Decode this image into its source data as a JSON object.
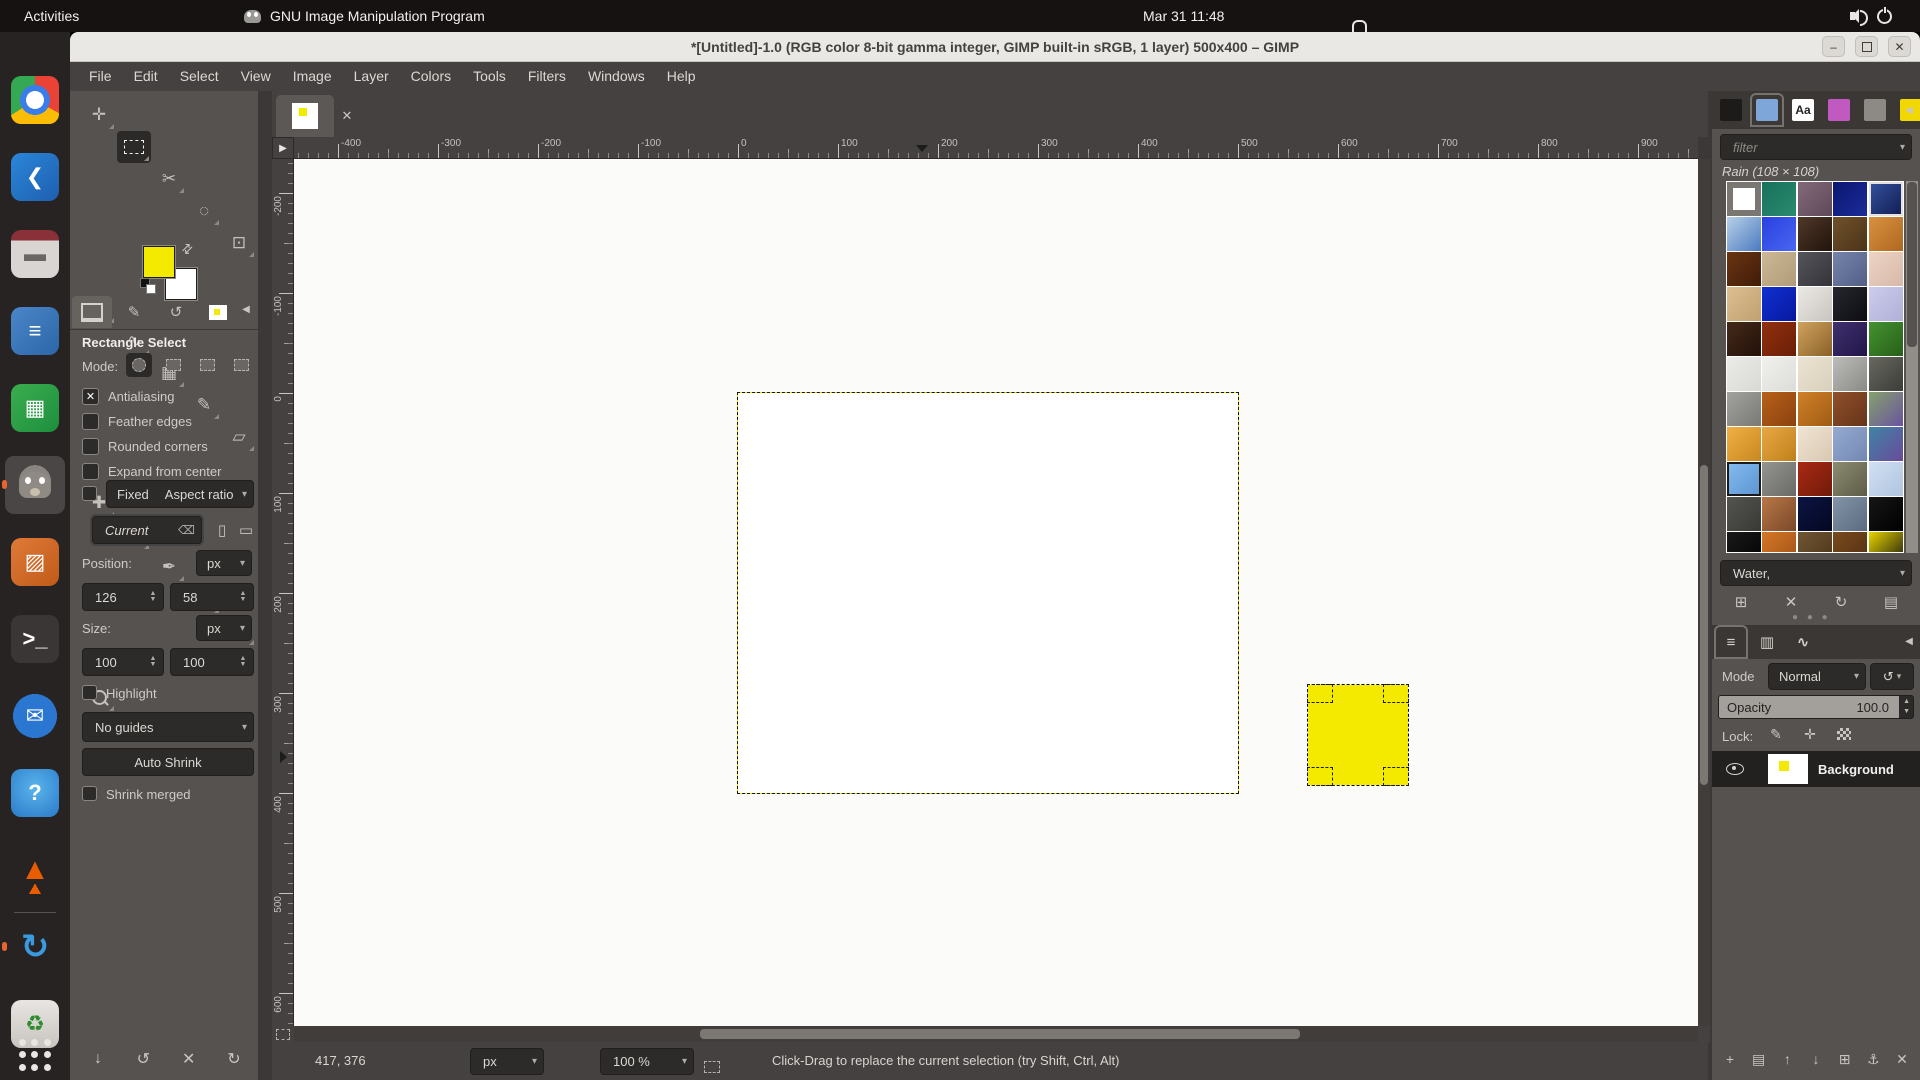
{
  "topbar": {
    "activities": "Activities",
    "app_name": "GNU Image Manipulation Program",
    "clock": "Mar 31 11:48",
    "right_icons": [
      "volume-icon",
      "power-icon"
    ]
  },
  "dock": {
    "apps": [
      {
        "name": "chrome"
      },
      {
        "name": "vscode"
      },
      {
        "name": "files"
      },
      {
        "name": "libreoffice-writer"
      },
      {
        "name": "libreoffice-calc"
      },
      {
        "name": "gimp",
        "active": true,
        "running": true
      },
      {
        "name": "libreoffice-impress"
      },
      {
        "name": "terminal"
      },
      {
        "name": "thunderbird"
      },
      {
        "name": "help"
      },
      {
        "name": "vlc"
      },
      {
        "name": "software-updater",
        "running": true
      },
      {
        "name": "trash"
      }
    ],
    "show_apps": "show-applications"
  },
  "window": {
    "title": "*[Untitled]-1.0 (RGB color 8-bit gamma integer, GIMP built-in sRGB, 1 layer) 500x400 – GIMP",
    "controls": [
      {
        "name": "minimize",
        "glyph": "–"
      },
      {
        "name": "maximize",
        "glyph": ""
      },
      {
        "name": "close",
        "glyph": "✕"
      }
    ]
  },
  "menubar": {
    "items": [
      "File",
      "Edit",
      "Select",
      "View",
      "Image",
      "Layer",
      "Colors",
      "Tools",
      "Filters",
      "Windows",
      "Help"
    ]
  },
  "toolbox": {
    "tools": [
      {
        "name": "move",
        "glyph": "✛"
      },
      {
        "name": "rectangle-select",
        "glyph": "",
        "active": true
      },
      {
        "name": "scissors-select",
        "glyph": "✂"
      },
      {
        "name": "fuzzy-select",
        "glyph": "◌"
      },
      {
        "name": "crop",
        "glyph": "⊡"
      },
      {
        "name": "transform",
        "glyph": "↻"
      },
      {
        "name": "paths",
        "glyph": "∿"
      },
      {
        "name": "gradient",
        "glyph": "▦"
      },
      {
        "name": "paintbrush",
        "glyph": "✎"
      },
      {
        "name": "eraser",
        "glyph": "▱"
      },
      {
        "name": "heal",
        "glyph": "✚"
      },
      {
        "name": "smudge",
        "glyph": "◗"
      },
      {
        "name": "airbrush",
        "glyph": "✒"
      },
      {
        "name": "text",
        "glyph": "A"
      },
      {
        "name": "color-picker",
        "glyph": "⌖"
      },
      {
        "name": "zoom",
        "glyph": ""
      }
    ],
    "fg_color": "#f3ea00",
    "bg_color": "#ffffff",
    "tabs": [
      "tool-options",
      "device-status",
      "undo-history",
      "images"
    ],
    "footer_buttons": [
      {
        "name": "save-tool-preset",
        "glyph": "↓"
      },
      {
        "name": "restore-tool-preset",
        "glyph": "↺"
      },
      {
        "name": "delete-tool-preset",
        "glyph": "✕"
      },
      {
        "name": "reset-tool-options",
        "glyph": "↻"
      }
    ]
  },
  "tool_options": {
    "title": "Rectangle Select",
    "mode_label": "Mode:",
    "modes": [
      "replace",
      "add",
      "subtract",
      "intersect"
    ],
    "checkboxes": [
      {
        "label": "Antialiasing",
        "checked": true
      },
      {
        "label": "Feather edges",
        "checked": false
      },
      {
        "label": "Rounded corners",
        "checked": false
      },
      {
        "label": "Expand from center",
        "checked": false
      }
    ],
    "fixed_label": "Fixed",
    "fixed_checked": false,
    "fixed_value": "Aspect ratio",
    "current_value": "Current",
    "position_label": "Position:",
    "position_unit": "px",
    "position_x": "126",
    "position_y": "58",
    "size_label": "Size:",
    "size_unit": "px",
    "size_w": "100",
    "size_h": "100",
    "highlight_label": "Highlight",
    "highlight_checked": false,
    "guides_value": "No guides",
    "auto_shrink_label": "Auto Shrink",
    "shrink_merged_label": "Shrink merged",
    "shrink_merged_checked": false
  },
  "canvas": {
    "h_ticks": [
      -400,
      -300,
      -200,
      -100,
      0,
      100,
      200,
      300,
      400,
      500,
      600,
      700,
      800,
      900
    ],
    "v_ticks": [
      -200,
      -100,
      0,
      100,
      200,
      300,
      400,
      500,
      600
    ],
    "tab_close_glyph": "✕"
  },
  "statusbar": {
    "position": "417, 376",
    "unit": "px",
    "zoom": "100 %",
    "message": "Click-Drag to replace the current selection (try Shift, Ctrl, Alt)"
  },
  "right_dock": {
    "tabs": [
      {
        "name": "brushes",
        "color": "#1d1b1a"
      },
      {
        "name": "patterns",
        "color": "#7ea6d8",
        "active": true
      },
      {
        "name": "fonts",
        "color": "#ffffff",
        "text": "Aa"
      },
      {
        "name": "gradients",
        "color": "#c05ac0"
      },
      {
        "name": "palettes",
        "color": "#8d8985"
      },
      {
        "name": "images",
        "color": "#f0d800"
      }
    ],
    "filter_placeholder": "filter",
    "selected_pattern": "Rain (108 × 108)",
    "tag_value": "Water,",
    "pattern_buttons": [
      {
        "name": "duplicate-pattern",
        "glyph": "⊞"
      },
      {
        "name": "delete-pattern",
        "glyph": "✕"
      },
      {
        "name": "refresh-patterns",
        "glyph": "↻"
      },
      {
        "name": "open-pattern-as-image",
        "glyph": "▤"
      }
    ],
    "patterns_grid": [
      [
        [
          "#f4f4f2",
          "#dcdcda"
        ],
        [
          "#17715c",
          "#2a8a6e"
        ],
        [
          "#84687a",
          "#5e4a58"
        ],
        [
          "#0a1670",
          "#1c2c9a"
        ],
        [
          "#3452a0",
          "#101c50"
        ]
      ],
      [
        [
          "#b8d0e8",
          "#4a7ac0"
        ],
        [
          "#2840e0",
          "#4a66f0"
        ],
        [
          "#503828",
          "#20140c"
        ],
        [
          "#71512c",
          "#4a3418"
        ],
        [
          "#d89040",
          "#b06820"
        ]
      ],
      [
        [
          "#6a3412",
          "#401c08"
        ],
        [
          "#ccb896",
          "#b09c78"
        ],
        [
          "#55555c",
          "#333338"
        ],
        [
          "#7684ac",
          "#525f86"
        ],
        [
          "#ecd5c6",
          "#d8b8a8"
        ]
      ],
      [
        [
          "#dcbf92",
          "#c0a070"
        ],
        [
          "#1030d0",
          "#0818a0"
        ],
        [
          "#ece8e4",
          "#c8c4c0"
        ],
        [
          "#26262e",
          "#0c0c12"
        ],
        [
          "#ccccec",
          "#b0b0d8"
        ]
      ],
      [
        [
          "#44291a",
          "#221108"
        ],
        [
          "#92300f",
          "#6a1e06"
        ],
        [
          "#d0a35e",
          "#8a6028"
        ],
        [
          "#40306e",
          "#201648"
        ],
        [
          "#449230",
          "#276018"
        ]
      ],
      [
        [
          "#ebebe7",
          "#d8d8d4"
        ],
        [
          "#f0f0ec",
          "#dcdcd8"
        ],
        [
          "#ece4d2",
          "#d8d0bc"
        ],
        [
          "#bcbcb8",
          "#8a8a86"
        ],
        [
          "#686860",
          "#3c3c38"
        ]
      ],
      [
        [
          "#a2a29e",
          "#787874"
        ],
        [
          "#b86018",
          "#8a4210"
        ],
        [
          "#d08028",
          "#a05c14"
        ],
        [
          "#90502c",
          "#663418"
        ],
        [
          "#86a06a",
          "#6a54a0"
        ]
      ],
      [
        [
          "#f0b044",
          "#c88820"
        ],
        [
          "#e8a846",
          "#c08018"
        ],
        [
          "#f0e4d4",
          "#d8c8b0"
        ],
        [
          "#96aad0",
          "#7288b4"
        ],
        [
          "#3e84a6",
          "#6a4a9a"
        ]
      ],
      [
        [
          "#85bcf0",
          "#5a94d0"
        ],
        [
          "#949490",
          "#6a6a66"
        ],
        [
          "#aa2a14",
          "#701a08"
        ],
        [
          "#8c8c72",
          "#5c5c48"
        ],
        [
          "#d2e0f2",
          "#b0c4e0"
        ]
      ],
      [
        [
          "#545450",
          "#383834"
        ],
        [
          "#b87848",
          "#7a4828"
        ],
        [
          "#0c1444",
          "#040820"
        ],
        [
          "#8494a8",
          "#5a6a80"
        ],
        [
          "#161616",
          "#000000"
        ]
      ],
      [
        [
          "#1a1a1a",
          "#020202"
        ],
        [
          "#d47828",
          "#a05014"
        ],
        [
          "#705634",
          "#4a3418"
        ],
        [
          "#7a4a1e",
          "#50300f"
        ],
        [
          "#e8d400",
          "#111111"
        ]
      ],
      [
        [
          "#6a4a2a",
          "#44290f"
        ],
        [
          "#c87828",
          "#964e12"
        ],
        [
          "#8a6a4a",
          "#5c4228"
        ],
        [
          "#b07a3a",
          "#7a4e1e"
        ],
        [
          "#9a7a5a",
          "#6a4a30"
        ]
      ]
    ],
    "selected_cell": [
      0,
      4
    ],
    "focused_cell": [
      8,
      0
    ]
  },
  "layers": {
    "tabs": [
      {
        "name": "layers",
        "glyph": "≡",
        "active": true
      },
      {
        "name": "channels",
        "glyph": "▥"
      },
      {
        "name": "paths",
        "glyph": "∿"
      }
    ],
    "mode_label": "Mode",
    "mode_value": "Normal",
    "opacity_label": "Opacity",
    "opacity_value": "100.0",
    "lock_label": "Lock:",
    "lock_buttons": [
      {
        "name": "lock-pixels",
        "glyph": "✎"
      },
      {
        "name": "lock-position",
        "glyph": "✛"
      },
      {
        "name": "lock-alpha",
        "glyph": ""
      }
    ],
    "rows": [
      {
        "name": "Background",
        "visible": true
      }
    ],
    "bottom_buttons": [
      {
        "name": "new-layer",
        "glyph": "+"
      },
      {
        "name": "new-layer-group",
        "glyph": "▤"
      },
      {
        "name": "raise-layer",
        "glyph": "↑"
      },
      {
        "name": "lower-layer",
        "glyph": "↓"
      },
      {
        "name": "duplicate-layer",
        "glyph": "⊞"
      },
      {
        "name": "anchor-layer",
        "glyph": "⚓"
      },
      {
        "name": "delete-layer",
        "glyph": "✕"
      }
    ]
  },
  "colors": {
    "selection_yellow": "#f3ea00",
    "panel": "#55524f",
    "panel_dark": "#454140",
    "input_dark": "#2d2b29",
    "canvas_padding": "#fbfbf9",
    "accent_orange": "#e8652d"
  }
}
